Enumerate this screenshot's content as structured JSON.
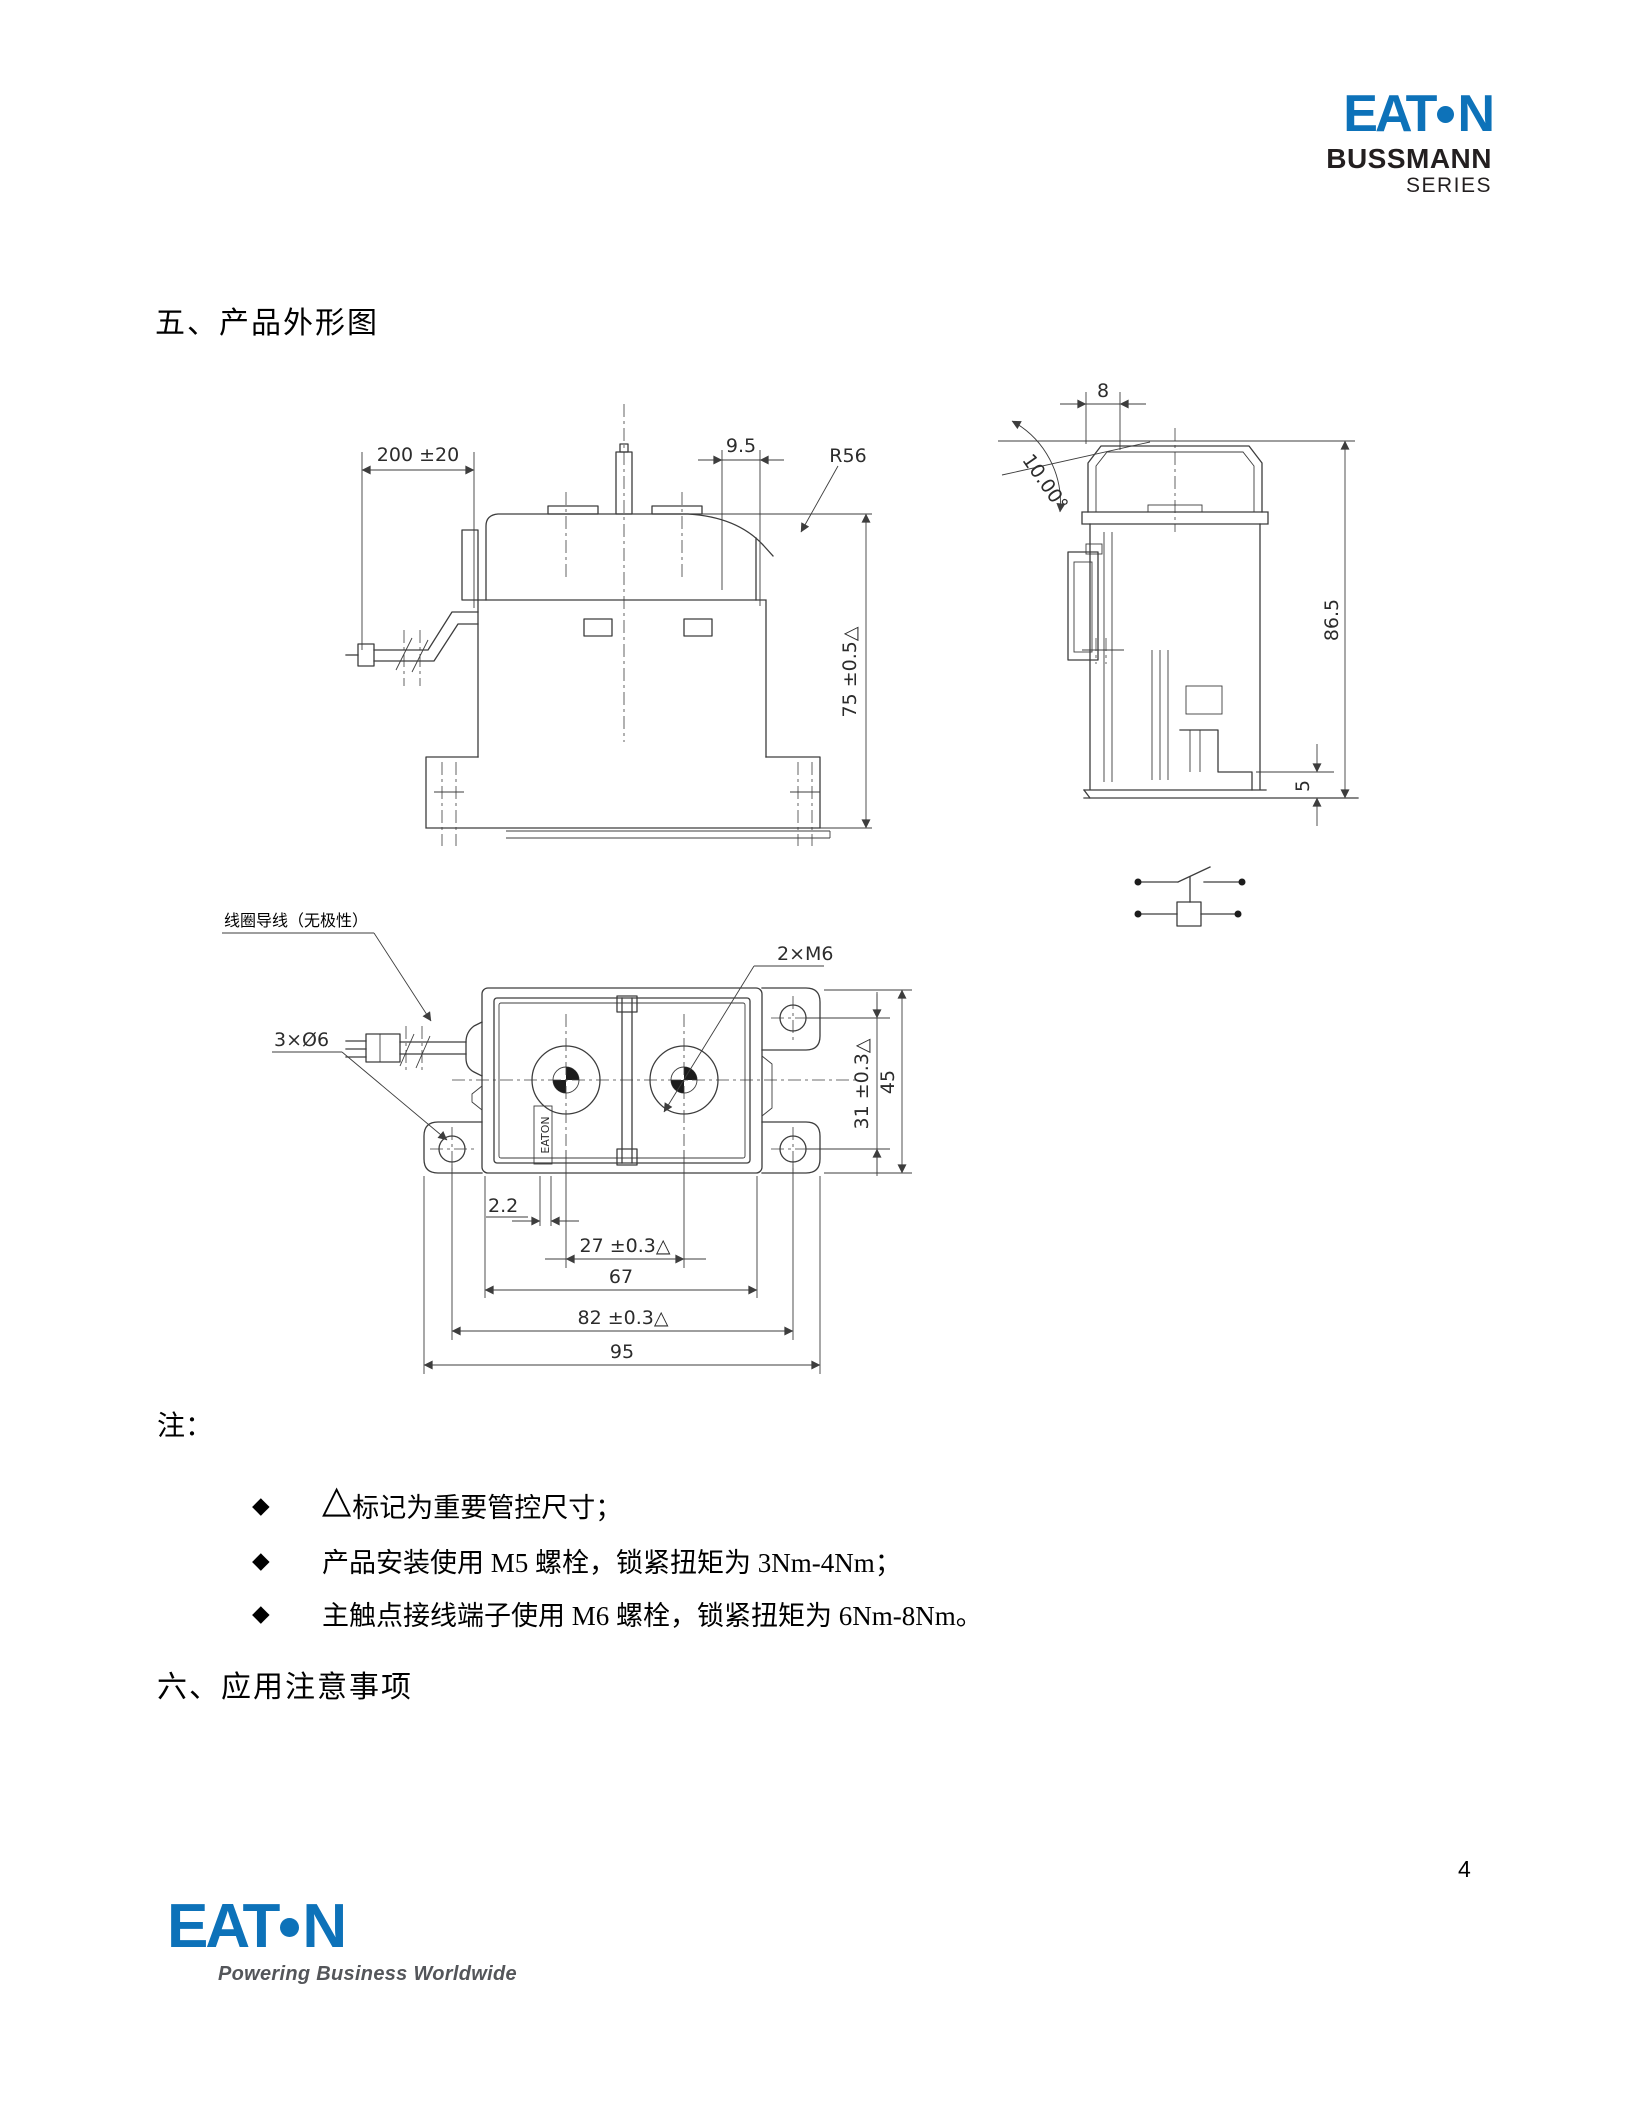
{
  "header": {
    "logo": {
      "prefix": "EAT",
      "suffix": "N"
    },
    "brand_line1": "BUSSMANN",
    "brand_line2": "SERIES"
  },
  "outline_section": {
    "title": "五、产品外形图"
  },
  "front_view": {
    "dim_wire_length": "200 ±20",
    "dim_top_offset": "9.5",
    "dim_radius": "R56",
    "dim_height": "75 ±0.5△"
  },
  "side_view": {
    "dim_top_width": "8",
    "dim_angle": "10.00°",
    "dim_height": "86.5",
    "dim_base": "5"
  },
  "top_view": {
    "label_coil_lead": "线圈导线（无极性）",
    "label_thread": "2×M6",
    "label_lead_dia": "3×Ø6",
    "brand_mark": "EATON",
    "dim_offset": "2.2",
    "dim_terminal_pitch": "27 ±0.3△",
    "dim_body_width": "67",
    "dim_mount_pitch": "82 ±0.3△",
    "dim_overall_width": "95",
    "dim_vert_pitch": "31 ±0.3△",
    "dim_depth": "45"
  },
  "notes": {
    "label": "注：",
    "items": [
      {
        "marker": "◆",
        "symbol": "△",
        "text": "标记为重要管控尺寸；"
      },
      {
        "marker": "◆",
        "text": "产品安装使用 M5 螺栓，锁紧扭矩为 3Nm-4Nm；"
      },
      {
        "marker": "◆",
        "text": "主触点接线端子使用 M6 螺栓，锁紧扭矩为 6Nm-8Nm。"
      }
    ]
  },
  "app_section": {
    "title": "六、应用注意事项"
  },
  "footer": {
    "logo": {
      "prefix": "EAT",
      "suffix": "N"
    },
    "tagline": "Powering Business Worldwide",
    "page_number": "4"
  },
  "colors": {
    "brand_blue": "#0d72b9",
    "line_color": "#3d3d3d"
  }
}
